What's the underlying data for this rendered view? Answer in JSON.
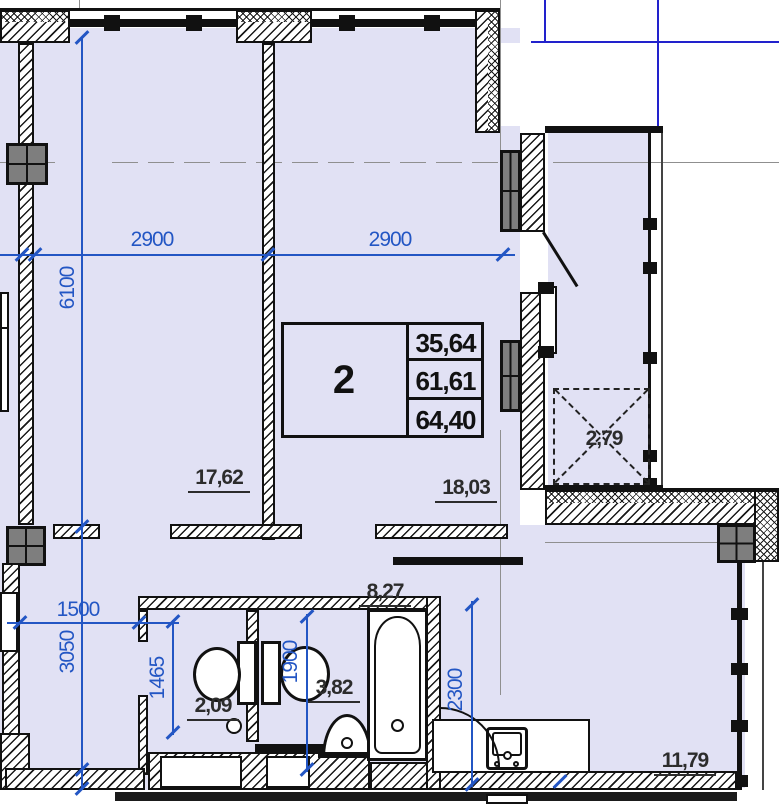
{
  "floor_plan": {
    "area_table": {
      "apartment_number": "2",
      "rows": [
        "35,64",
        "61,61",
        "64,40"
      ]
    },
    "room_areas": {
      "room1": "17,62",
      "room2": "18,03",
      "hall": "8,27",
      "bathroom": "3,82",
      "wc": "2,09",
      "kitchen": "11,79",
      "balcony": "2,79"
    },
    "dimensions": {
      "top_left": "2900",
      "top_right": "2900",
      "height_upper": "6100",
      "height_lower": "3050",
      "hall_width": "1500",
      "wc_depth": "1465",
      "bath_depth": "1900",
      "kitchen_depth": "2300"
    },
    "colors": {
      "room_fill": "#e1e1f4",
      "dimension_blue": "#2356c4",
      "grid_blue": "#2222cc",
      "column_gray": "#7e7e7e",
      "wall_line": "#111111",
      "label_color": "#2c2c2c"
    }
  }
}
